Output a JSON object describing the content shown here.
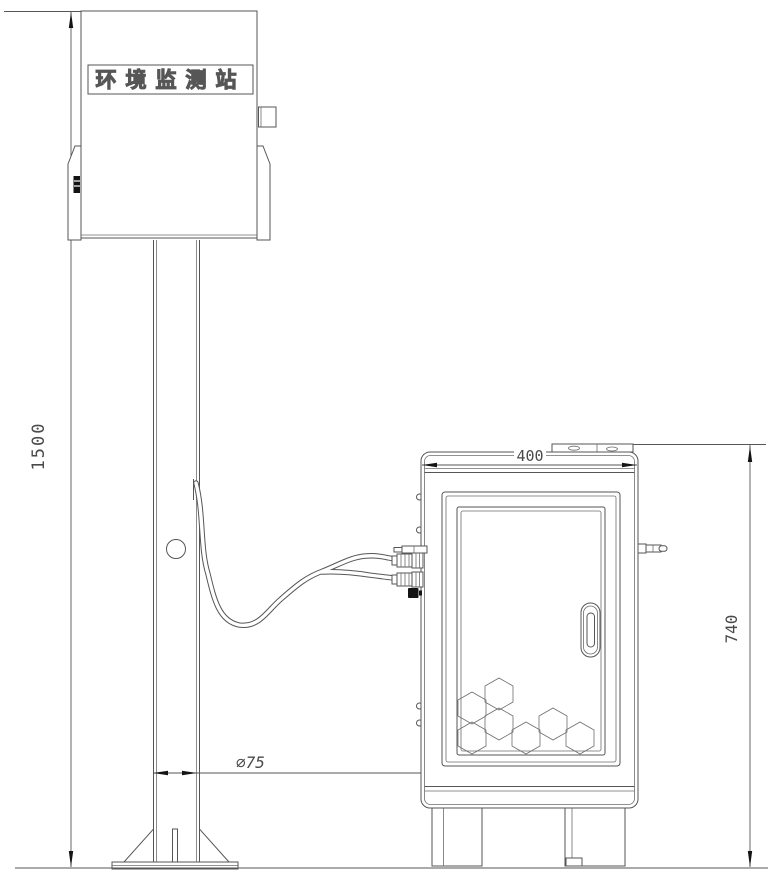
{
  "drawing": {
    "kind": "environmental-monitoring-station-installation-drawing",
    "station_label": "环境监测站",
    "dims": {
      "pole_height": "1500",
      "pole_diameter": "∅75",
      "cabinet_width": "400",
      "cabinet_height": "740"
    },
    "colors": {
      "line": "#565656",
      "line-light": "#6e6e6e",
      "dark": "#141414",
      "text": "#4a4a4a",
      "background": "#ffffff"
    }
  }
}
